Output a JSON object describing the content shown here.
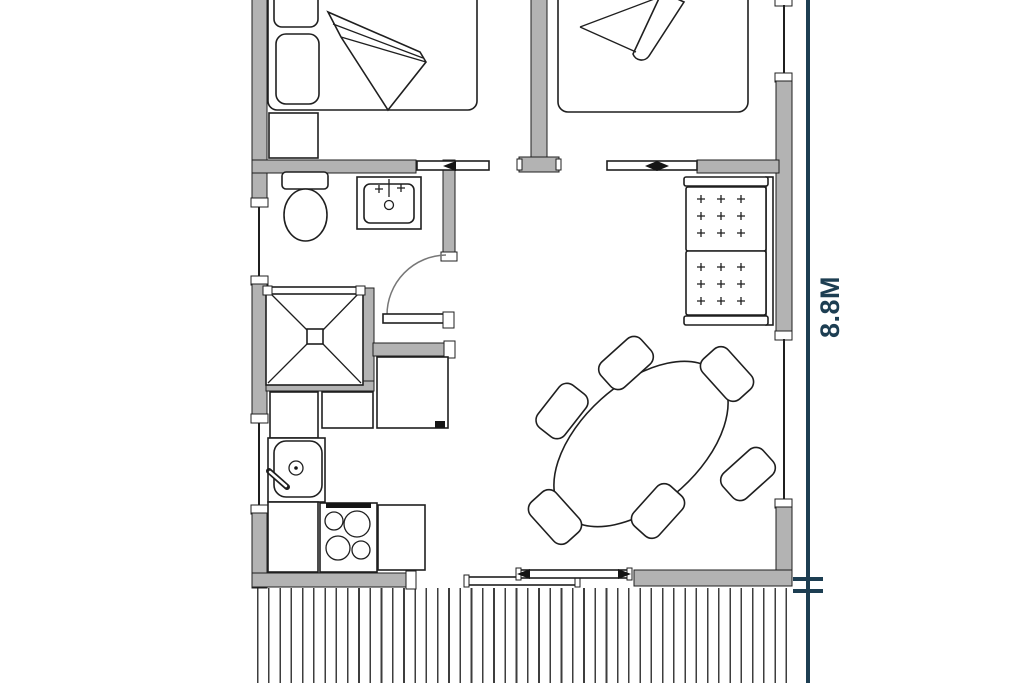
{
  "figure": {
    "type": "floor-plan"
  },
  "annotations": {
    "height_dimension": {
      "label": "8.8M"
    }
  },
  "colors": {
    "background": "#ffffff",
    "wall_fill": "#b3b3b3",
    "wall_outline": "#1f1f1f",
    "furniture_outline": "#1f1f1f",
    "deck_plank_line": "#3d3d3d",
    "dimension_accent": "#1d3e52"
  },
  "icons": [
    {
      "name": "double-bed-icon"
    },
    {
      "name": "single-bed-icon"
    },
    {
      "name": "nightstand-icon"
    },
    {
      "name": "toilet-icon"
    },
    {
      "name": "bathroom-sink-icon"
    },
    {
      "name": "shower-icon"
    },
    {
      "name": "kitchen-sink-icon"
    },
    {
      "name": "stove-icon"
    },
    {
      "name": "refrigerator-icon"
    },
    {
      "name": "dining-table-icon"
    },
    {
      "name": "chair-icon"
    },
    {
      "name": "sofa-icon"
    },
    {
      "name": "sliding-door-icon"
    },
    {
      "name": "hinged-door-icon"
    },
    {
      "name": "window-icon"
    },
    {
      "name": "deck-planks-icon"
    }
  ]
}
